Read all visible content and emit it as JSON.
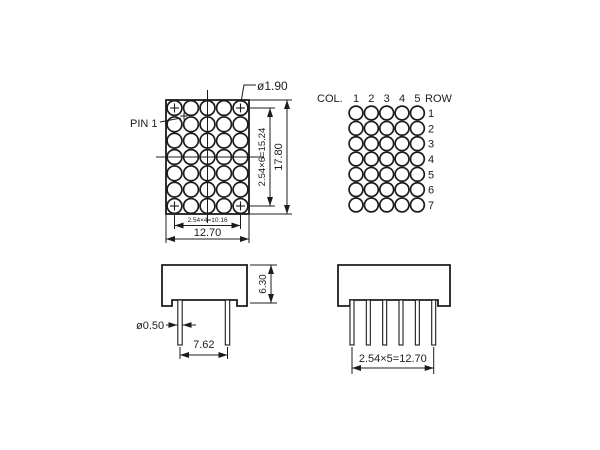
{
  "front_view": {
    "pin1_label": "PIN 1",
    "dot_diameter_label": "ø1.90",
    "row_pitch_label": "2.54×6=15.24",
    "overall_height_label": "17.80",
    "col_pitch_label": "2.54×4=10.16",
    "overall_width_label": "12.70",
    "columns": 5,
    "rows": 7
  },
  "pin_map": {
    "col_header": "COL.",
    "row_header": "ROW",
    "col_numbers": [
      "1",
      "2",
      "3",
      "4",
      "5"
    ],
    "row_numbers": [
      "1",
      "2",
      "3",
      "4",
      "5",
      "6",
      "7"
    ]
  },
  "side_view": {
    "body_height_label": "6.30",
    "pin_diameter_label": "ø0.50",
    "pin_row_spacing_label": "7.62",
    "pin_count": 2
  },
  "bottom_view": {
    "pin_pitch_label": "2.54×5=12.70",
    "pin_count": 6
  },
  "colors": {
    "ink": "#1c1c1c",
    "background": "#ffffff"
  }
}
